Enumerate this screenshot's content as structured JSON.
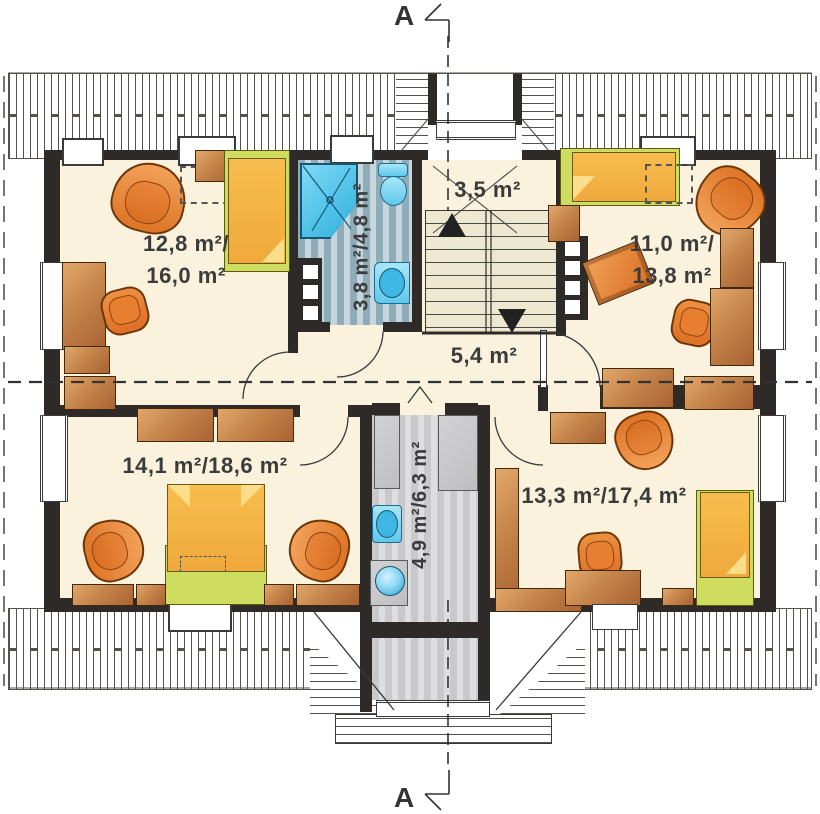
{
  "markers": {
    "top": "A",
    "bottom": "A"
  },
  "rooms": {
    "bedroom_top_left": {
      "area_line1": "12,8 m²/",
      "area_line2": "16,0 m²"
    },
    "landing": {
      "area": "3,5 m²"
    },
    "bathroom": {
      "area": "3,8 m²/4,8 m²"
    },
    "bedroom_top_right": {
      "area_line1": "11,0 m²/",
      "area_line2": "13,8 m²"
    },
    "hall": {
      "area": "5,4 m²"
    },
    "bedroom_bottom_left": {
      "area": "14,1 m²/18,6 m²"
    },
    "utility": {
      "area": "4,9 m²/6,3 m²"
    },
    "bedroom_bottom_right": {
      "area": "13,3 m²/17,4 m²"
    }
  },
  "colors": {
    "floor": "#faf2dc",
    "wall": "#2e2a27",
    "furniture_orange": "#de7426",
    "wood": "#c5854a",
    "bed_green": "#cedc60",
    "bath_tile": "#8facb8",
    "fixture_blue": "#4fc7ee",
    "utility_floor": "#dedee0"
  }
}
